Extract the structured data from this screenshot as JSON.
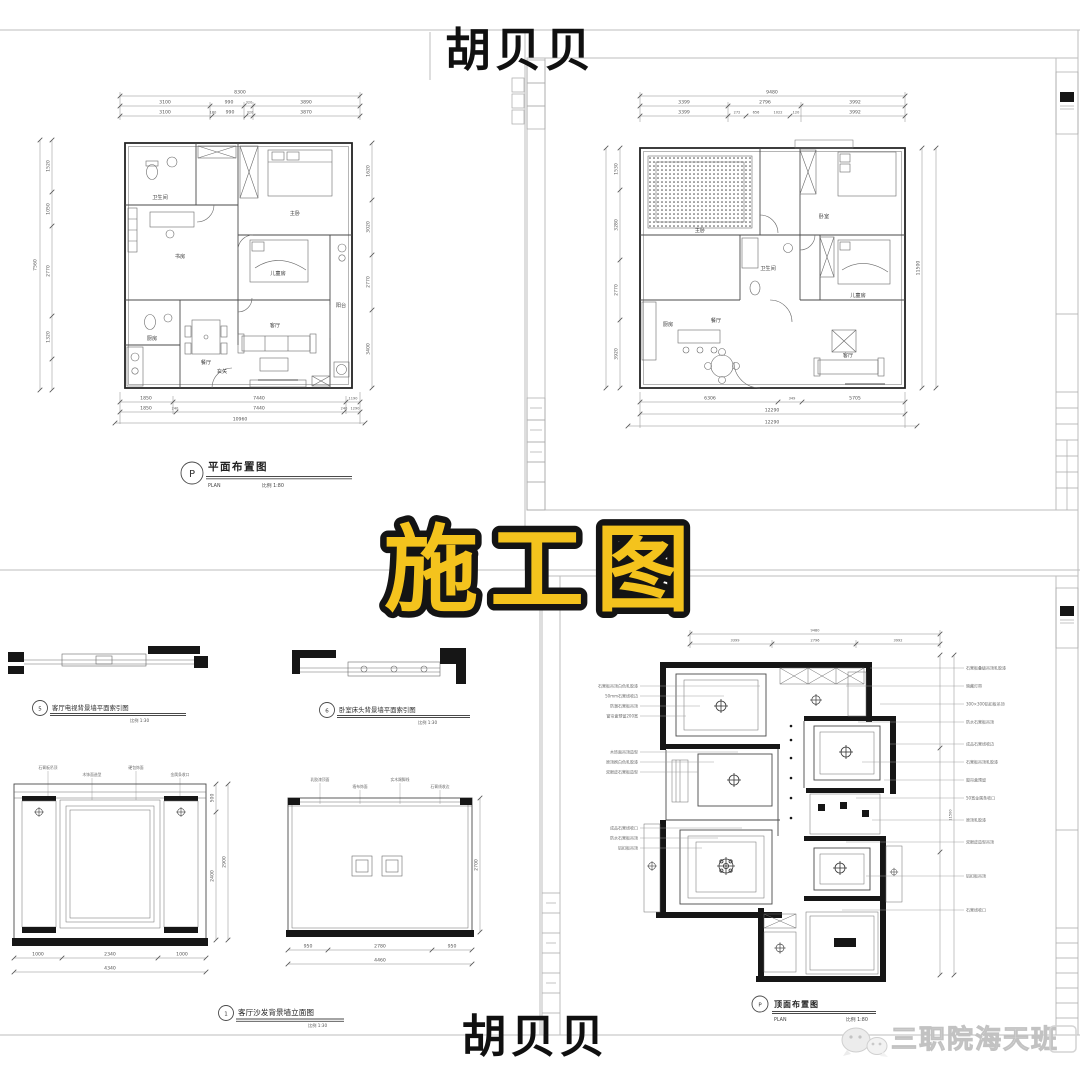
{
  "colors": {
    "paper": "#FFFFFF",
    "main_title_fill": "#F4C31D",
    "main_title_stroke": "#141414",
    "name_ink": "#111111",
    "watermark_gray": "#DADADA",
    "drawing_line": "#555555",
    "wall_ink": "#1A1A1A",
    "sheet_frame": "#BDBDBD"
  },
  "overlays": {
    "top_name": "胡贝贝",
    "main_title": "施工图",
    "bottom_name": "胡贝贝",
    "watermark": "三职院海天班"
  },
  "plan_top_left": {
    "tag": "P",
    "title": "平面布置图",
    "plan_label": "PLAN",
    "scale_label": "比例 1:80",
    "rooms": {
      "bath": "卫生间",
      "master": "主卧",
      "study": "书房",
      "kids": "儿童房",
      "dining": "餐厅",
      "kitchen": "厨房",
      "living": "客厅",
      "balcony": "阳台",
      "entry": "玄关"
    },
    "dims": {
      "top_total": "8300",
      "top": [
        "3100",
        "990",
        "320",
        "3890"
      ],
      "top2": [
        "3100",
        "180",
        "990",
        "320",
        "3870"
      ],
      "left_total": "7560",
      "left": [
        "1520",
        "1050",
        "2770",
        "1320"
      ],
      "right": [
        "1620",
        "3020",
        "2770",
        "3400"
      ],
      "bottom": [
        "1850",
        "7440",
        "1190"
      ],
      "bottom2": [
        "1850",
        "240",
        "7440",
        "240",
        "1290"
      ],
      "bottom_total": "10960"
    }
  },
  "plan_top_right": {
    "rooms": {
      "master": "主卧",
      "second": "卧室",
      "kids": "儿童房",
      "bath": "卫生间",
      "kitchen": "厨房",
      "dining": "餐厅",
      "living": "客厅"
    },
    "dims": {
      "top_total": "9480",
      "top": [
        "3399",
        "2796",
        "3992"
      ],
      "top2": [
        "3399",
        "272",
        "656",
        "1022",
        "120",
        "3992"
      ],
      "left": [
        "1530",
        "3280",
        "2770",
        "3920"
      ],
      "right_total": "11500",
      "bottom": [
        "6306",
        "349",
        "5705"
      ],
      "bottom_total": "12290",
      "bottom_total2": "12290"
    }
  },
  "elevations": {
    "index1": {
      "tag": "5",
      "title": "客厅电视背景墙平面索引图",
      "scale": "比例 1:30"
    },
    "index2": {
      "tag": "6",
      "title": "卧室床头背景墙平面索引图",
      "scale": "比例 1:30"
    },
    "main_caption": {
      "tag": "1",
      "title": "客厅沙发背景墙立面图",
      "scale": "比例 1:30"
    },
    "left_elev": {
      "callouts": [
        "石膏板吊顶",
        "木饰面造型",
        "硬包饰面",
        "金属条收口"
      ],
      "dims": [
        "1000",
        "2340",
        "1000"
      ],
      "total": "4340",
      "heights": [
        "500",
        "2400"
      ],
      "height_total": "2900"
    },
    "right_elev": {
      "callouts": [
        "乳胶漆顶面",
        "墙布饰面",
        "实木踢脚线",
        "石膏线收边"
      ],
      "dims": [
        "950",
        "2780",
        "950"
      ],
      "total": "4460",
      "height": "2700"
    }
  },
  "ceiling_plan": {
    "tag": "P",
    "title": "顶面布置图",
    "plan_label": "PLAN",
    "scale_label": "比例 1:80",
    "top_total": "9480",
    "top_dims": [
      "3399",
      "2796",
      "3992"
    ],
    "right_total": "11500",
    "callouts_left": [
      "石膏板吊顶白色乳胶漆",
      "50mm石膏线收边",
      "防潮石膏板吊顶",
      "窗帘盒预留200宽",
      "木饰面吊顶造型",
      "原顶刷白色乳胶漆",
      "双眼皮石膏板造型",
      "成品石膏线收口",
      "防水石膏板吊顶",
      "铝扣板吊顶"
    ],
    "callouts_right": [
      "石膏板叠级吊顶乳胶漆",
      "暗藏灯带",
      "300×300铝扣板吊顶",
      "防水石膏板吊顶",
      "成品石膏线收边",
      "石膏板吊顶乳胶漆",
      "窗帘盒预留",
      "50宽金属条收口",
      "原顶乳胶漆",
      "双眼皮造型吊顶",
      "铝扣板吊顶",
      "石膏线收口"
    ]
  }
}
